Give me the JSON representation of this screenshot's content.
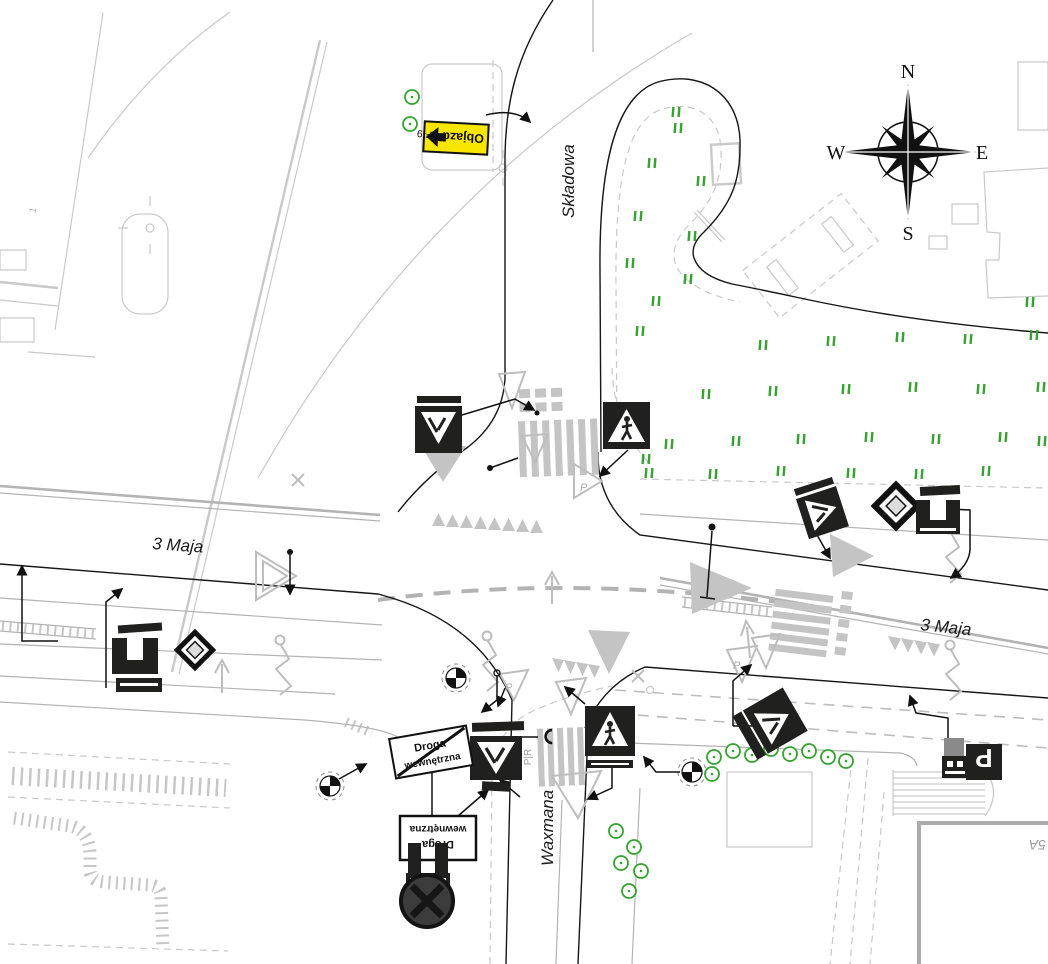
{
  "compass": {
    "north": "N",
    "east": "E",
    "south": "S",
    "west": "W"
  },
  "streets": {
    "skladowa": "Składowa",
    "maja_west": "3 Maja",
    "maja_east": "3 Maja",
    "waxmana": "Waxmana"
  },
  "signs": {
    "detour": {
      "label": "Objazd",
      "code": "F-9"
    },
    "internal_road": {
      "line1": "Droga",
      "line2": "wewnętrzna"
    },
    "internal_road_end": {
      "line1": "Droga",
      "line2": "wewnętrzna"
    },
    "parking": {
      "letter": "P"
    }
  },
  "pavement_labels": {
    "crossing": "P|R",
    "triangle_p_1": "P",
    "triangle_p_2": "P",
    "triangle_p_3": "P"
  },
  "misc_labels": {
    "building": "5A",
    "point": "1"
  },
  "colors": {
    "detour_yellow": "#f7e600",
    "sign_dark": "#20201e",
    "survey_gray": "#c9c9c9",
    "road_gray": "#b3b3b3",
    "marking_gray": "#c4c4c4",
    "vegetation_green": "#35a32f",
    "line_black": "#161616"
  }
}
